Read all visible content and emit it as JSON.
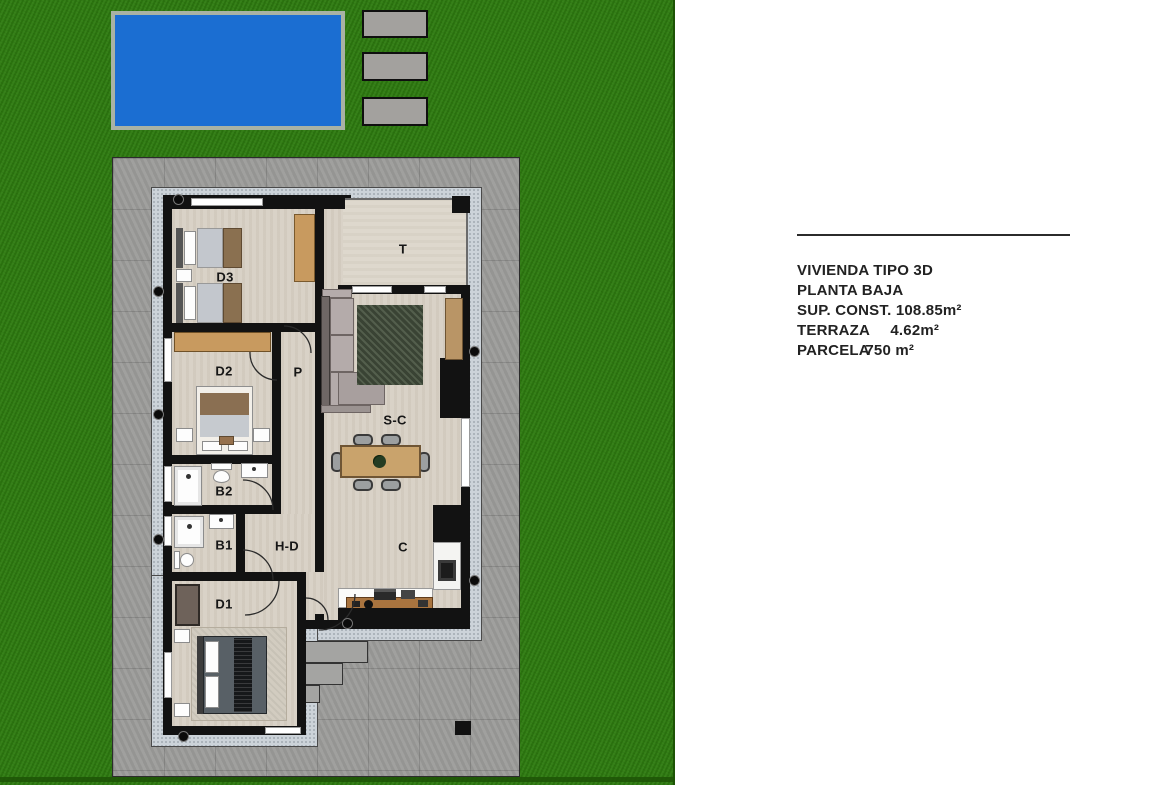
{
  "legend": {
    "title": "VIVIENDA TIPO 3D",
    "floor": "PLANTA BAJA",
    "built_area": "SUP. CONST. 108.85m²",
    "terrace_label": "TERRAZA",
    "terrace_value": "4.62m²",
    "plot_label": "PARCELA",
    "plot_value": "750 m²"
  },
  "plan": {
    "rooms": {
      "d3": {
        "label": "D3"
      },
      "d2": {
        "label": "D2"
      },
      "p": {
        "label": "P"
      },
      "b2": {
        "label": "B2"
      },
      "b1": {
        "label": "B1"
      },
      "hd": {
        "label": "H-D"
      },
      "d1": {
        "label": "D1"
      },
      "t": {
        "label": "T"
      },
      "sc": {
        "label": "S-C"
      },
      "c": {
        "label": "C"
      }
    }
  },
  "colors": {
    "lawn": "#2e7c10",
    "lawn-dark": "#1d5406",
    "pool": "#1b6ed2",
    "pool-border": "#a9b2a4",
    "slab": "#a3a19e",
    "pavement": "#9b9b99",
    "band": "#ccd3d9",
    "wall": "#121212",
    "floor": "#d9d2c7",
    "terrace-floor": "#ded8cd",
    "wood": "#c89a5f",
    "wood-dark": "#a9743f",
    "rug-green": "#46523f",
    "text": "#222222"
  }
}
